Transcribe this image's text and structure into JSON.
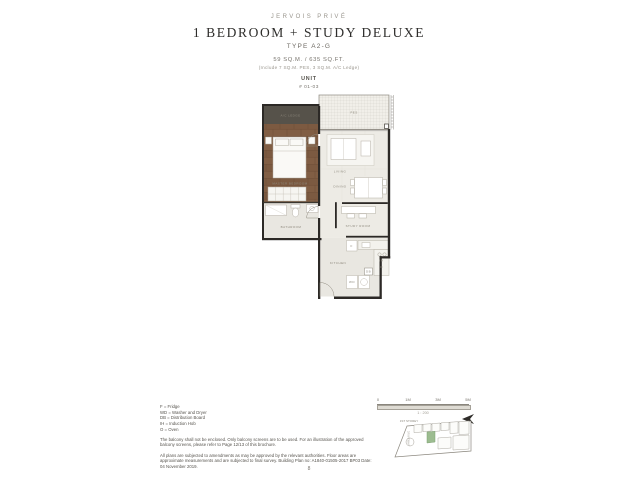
{
  "header": {
    "brand": "JERVOIS PRIVÉ",
    "title": "1 BEDROOM + STUDY DELUXE",
    "unit_type": "TYPE A2-G",
    "area": "59 SQ.M. / 635 SQ.FT.",
    "area_note": "(Include 7 SQ.M. PES, 3 SQ.M. A/C Ledge)",
    "unit_label": "UNIT",
    "unit_number": "# 01-03"
  },
  "plan": {
    "rooms": {
      "ac_ledge": "A/C LEDGE",
      "pes": "PES",
      "master_bedroom": "MASTER BEDROOM",
      "bathroom": "BATHROOM",
      "living": "LIVING",
      "dining": "DINING",
      "study": "STUDY ROOM",
      "kitchen": "KITCHEN"
    },
    "appliances": {
      "fridge": "F",
      "washer_dryer": "WD",
      "distribution_board": "DB",
      "induction_hob": "IH",
      "oven": "O"
    }
  },
  "legend": {
    "items": [
      "F = Fridge",
      "WD = Washer and Dryer",
      "DB = Distribution Board",
      "IH = Induction Hob",
      "O = Oven"
    ]
  },
  "disclaimers": {
    "balcony": "The balcony shall not be enclosed. Only balcony screens are to be used. For an illustration of the approved balcony screens, please refer to Page 12/13 of this brochure.",
    "plans": "All plans are subjected to amendments as may be approved by the relevant authorities. Floor areas are approximate measurements and are subjected to final survey. Building Plan no: A1840-01505-2017 BP03 Date: 04 November 2019."
  },
  "scale_bar": {
    "ticks": [
      "0",
      "1M",
      "3M",
      "5M"
    ],
    "caption": "1 : 200"
  },
  "key_plan": {
    "storey": "1ST STOREY",
    "road": "DRIVEWAY",
    "highlight_color": "#9cbc90"
  },
  "footer": {
    "page": "8"
  },
  "colors": {
    "wall": "#2c2926",
    "wood_floor": "#7c5a41",
    "ac_ledge_fill": "#56524a",
    "marble_floor": "#edebe5",
    "unit_highlight": "#9cbc90"
  }
}
